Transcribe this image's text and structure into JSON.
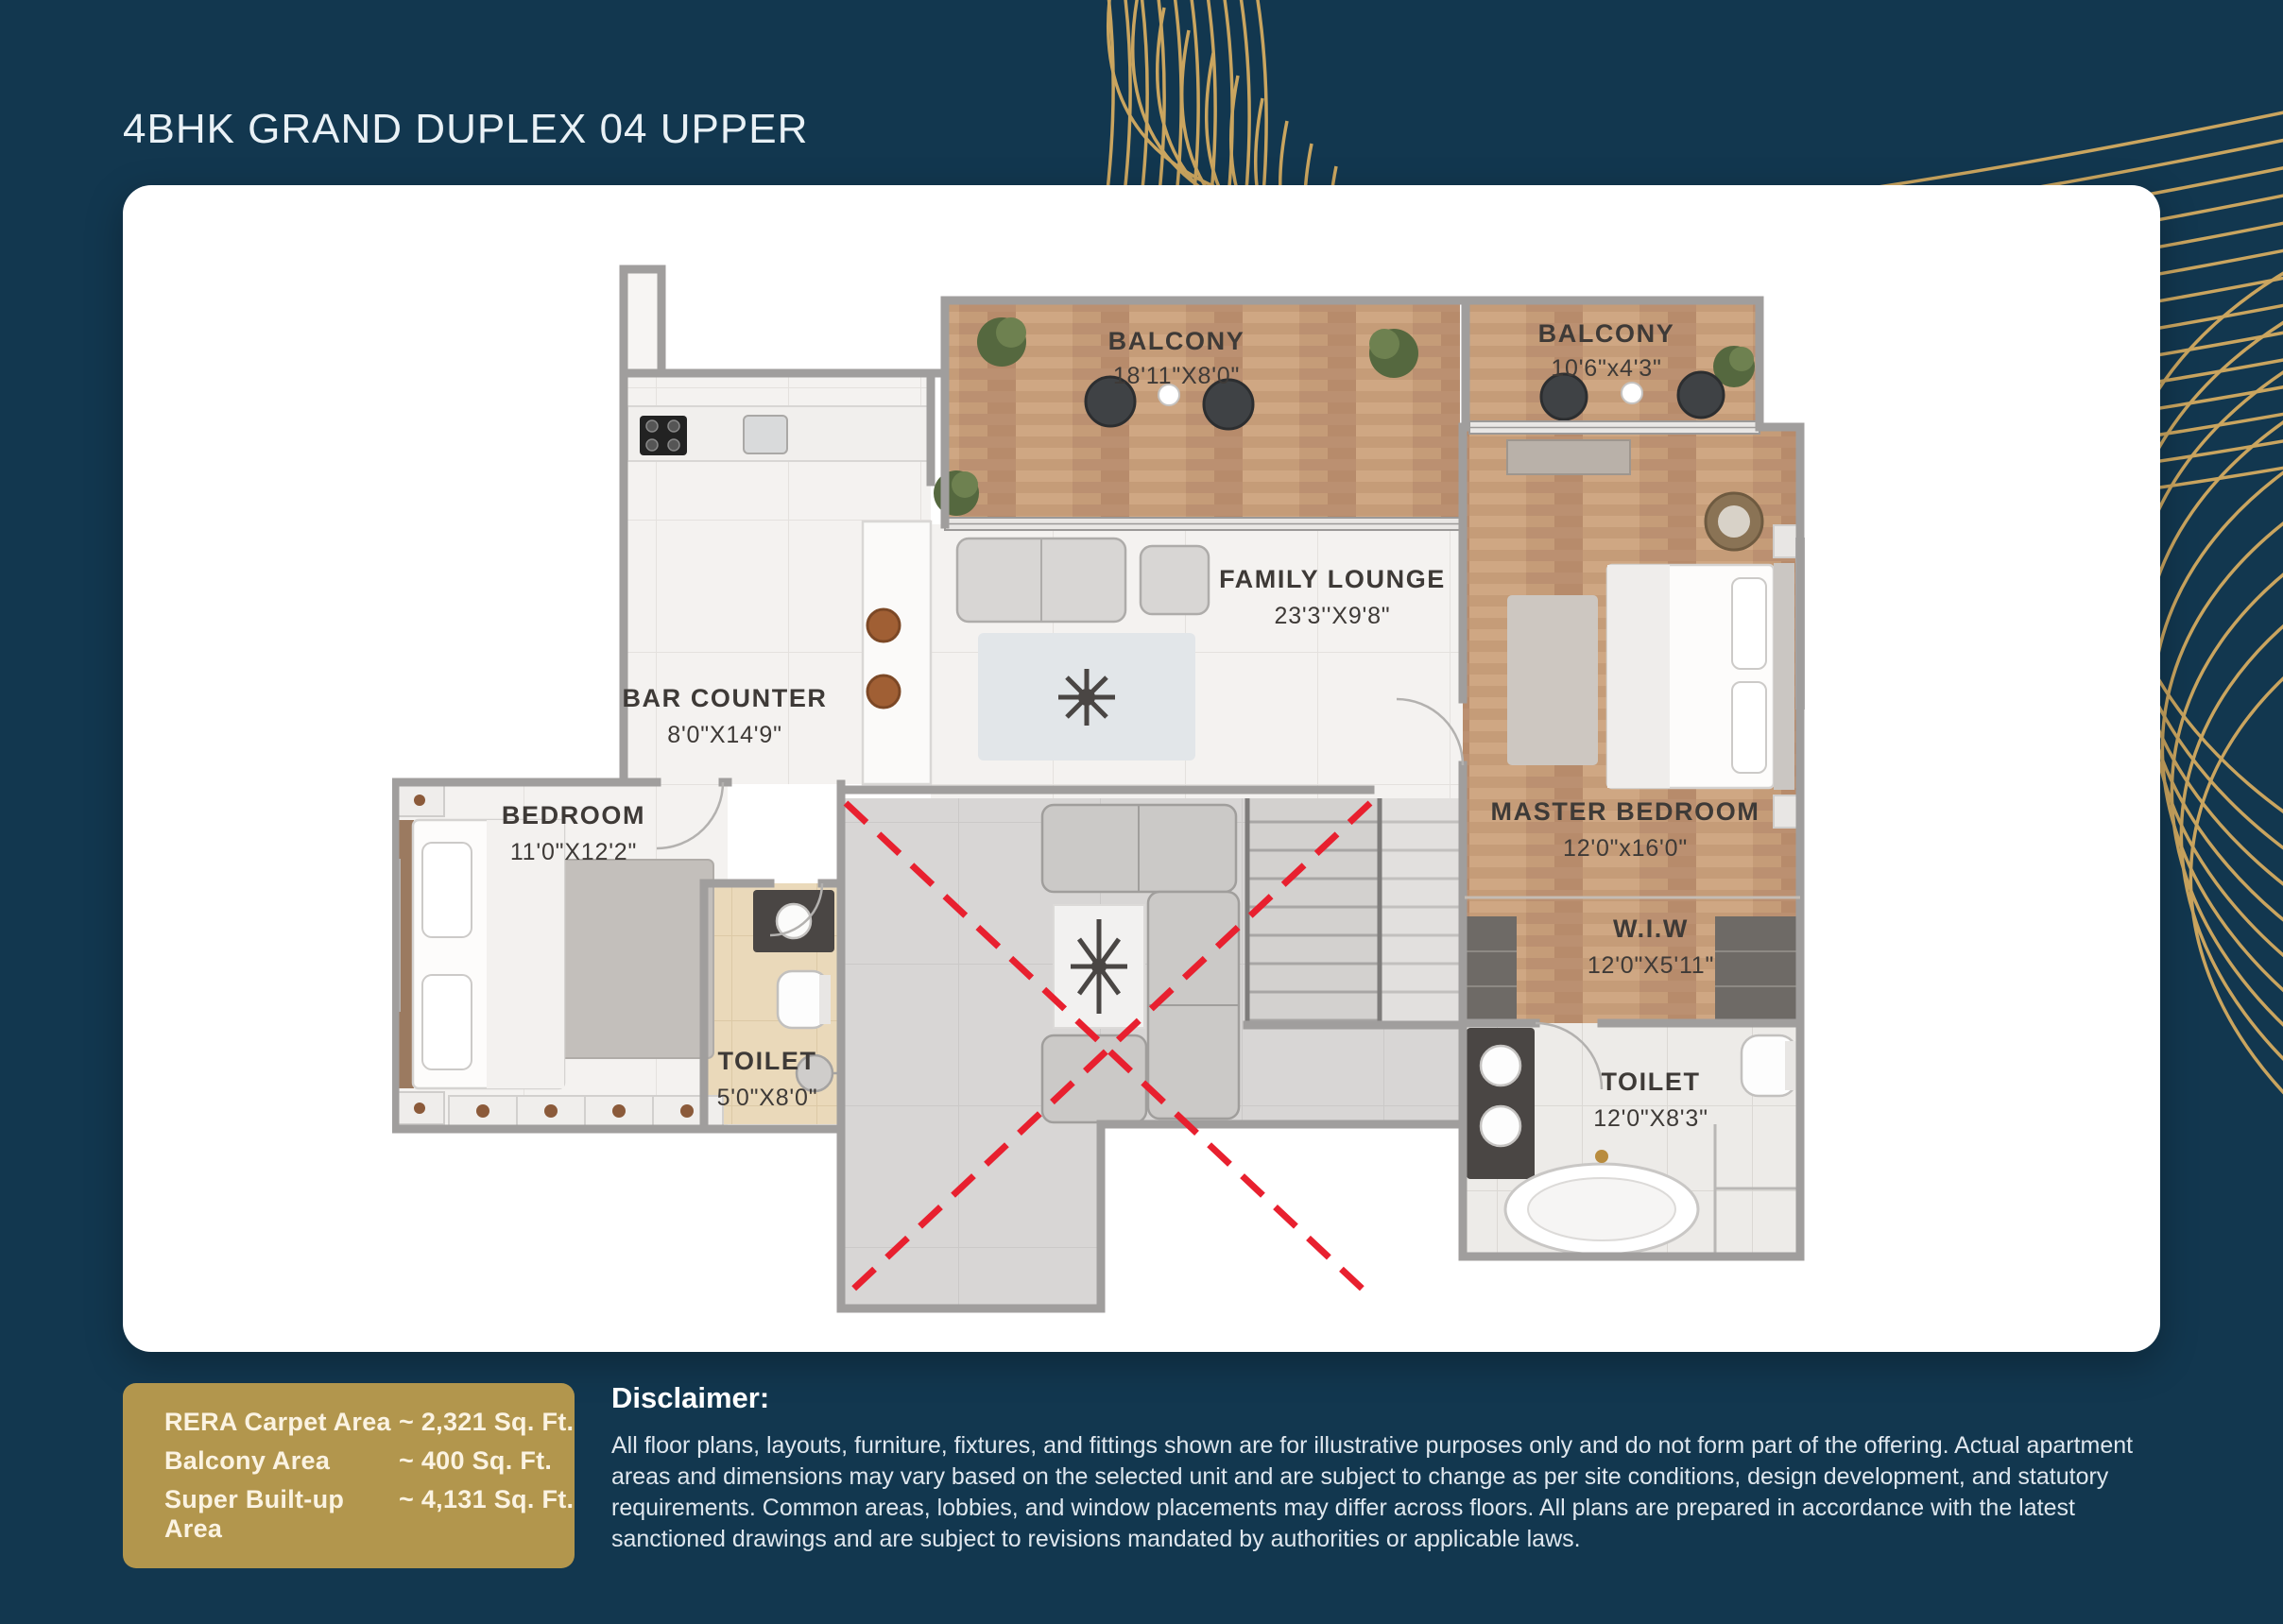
{
  "page": {
    "title": "4BHK GRAND DUPLEX 04 UPPER"
  },
  "colors": {
    "background_navy": "#12374F",
    "accent_gold": "#D5AB60",
    "info_box_gold": "#B2964D",
    "card_white": "#FFFFFF",
    "void_cross_red": "#E8202F",
    "wood_floor": "#C59C78",
    "label_text": "#3E3A37"
  },
  "floorplan": {
    "rooms": [
      {
        "id": "balcony-1",
        "name": "BALCONY",
        "dims": "18'11\"X8'0\""
      },
      {
        "id": "balcony-2",
        "name": "BALCONY",
        "dims": "10'6\"x4'3\""
      },
      {
        "id": "family-lounge",
        "name": "FAMILY LOUNGE",
        "dims": "23'3''X9'8\""
      },
      {
        "id": "bar-counter",
        "name": "BAR COUNTER",
        "dims": "8'0\"X14'9\""
      },
      {
        "id": "bedroom",
        "name": "BEDROOM",
        "dims": "11'0\"X12'2\""
      },
      {
        "id": "master-bedroom",
        "name": "MASTER BEDROOM",
        "dims": "12'0\"x16'0\""
      },
      {
        "id": "wiw",
        "name": "W.I.W",
        "dims": "12'0\"X5'11\""
      },
      {
        "id": "toilet-small",
        "name": "TOILET",
        "dims": "5'0\"X8'0\""
      },
      {
        "id": "toilet-master",
        "name": "TOILET",
        "dims": "12'0\"X8'3\""
      }
    ]
  },
  "area_summary": {
    "rows": [
      {
        "label": "RERA Carpet Area",
        "value": "~ 2,321 Sq. Ft."
      },
      {
        "label": "Balcony Area",
        "value": "~ 400 Sq. Ft."
      },
      {
        "label": "Super Built-up Area",
        "value": "~ 4,131 Sq. Ft."
      }
    ]
  },
  "disclaimer": {
    "heading": "Disclaimer:",
    "body": "All floor plans, layouts, furniture, fixtures, and fittings shown are for illustrative purposes only and do not form part of the offering. Actual apartment areas and dimensions may vary based on the selected unit and are subject to change as per site conditions, design development, and statutory requirements. Common areas, lobbies, and window placements may differ across floors. All plans are prepared in accordance with the latest sanctioned drawings and are subject to revisions mandated by authorities or applicable laws."
  }
}
